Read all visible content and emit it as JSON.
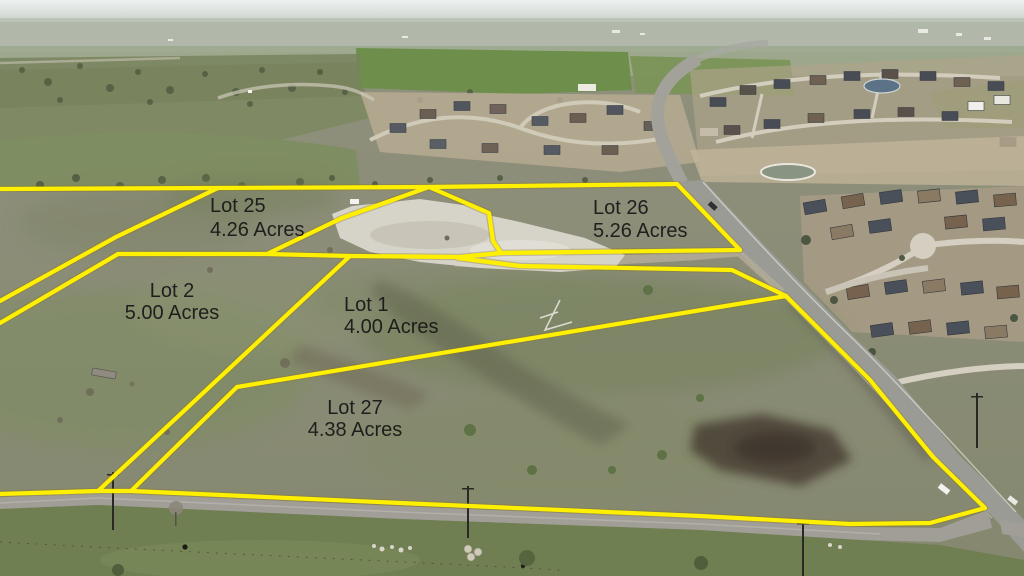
{
  "scene": {
    "type": "aerial-lot-survey-photo",
    "boundary_line_color": "#ffef00",
    "label_color": "#161616"
  },
  "lots": [
    {
      "name": "Lot 25",
      "acres": "4.26 Acres"
    },
    {
      "name": "Lot 26",
      "acres": "5.26 Acres"
    },
    {
      "name": "Lot 2",
      "acres": "5.00 Acres"
    },
    {
      "name": "Lot 1",
      "acres": "4.00 Acres"
    },
    {
      "name": "Lot 27",
      "acres": "4.38 Acres"
    }
  ]
}
